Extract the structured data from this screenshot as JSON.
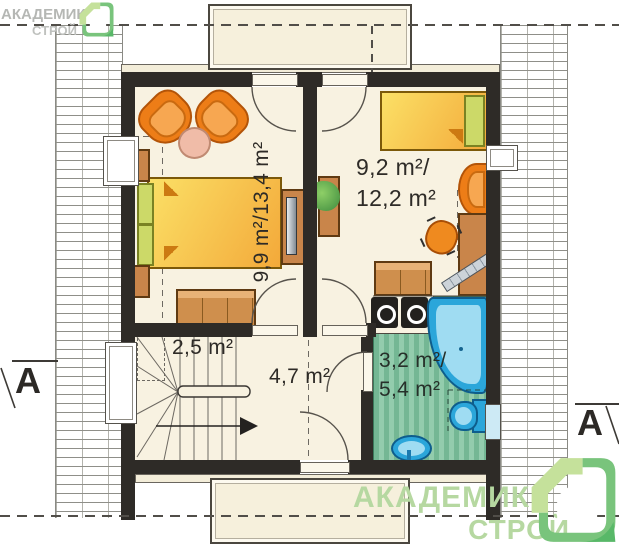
{
  "branding": {
    "logo_top_left": {
      "line1": "АКАДЕМИК",
      "line2": "СТРОЙ"
    },
    "logo_bottom_right": {
      "line1": "АКАДЕМИК",
      "line2": "СТРОЙ"
    }
  },
  "section_markers": {
    "left_label": "A",
    "right_label": "A"
  },
  "rooms": {
    "bedroom_left": {
      "area_label": "9,9 m²/13,4 m²"
    },
    "bedroom_right": {
      "area_line1": "9,2 m²/",
      "area_line2": "12,2 m²"
    },
    "staircase": {
      "area_label": "2,5 m²"
    },
    "hallway": {
      "area_label": "4,7 m²"
    },
    "bathroom": {
      "area_line1": "3,2 m²/",
      "area_line2": "5,4 m²"
    }
  },
  "palette": {
    "logo_green": "#8dc63f",
    "logo_gray_text": "#b5b7b4",
    "logo_light_green_text": "#b6d8a1",
    "wall_color": "#2e2b27",
    "floor_cream": "#f8f2e1",
    "furniture_orange": "#ed7d17",
    "furniture_brown": "#cf8f4d",
    "bed_yellow": "#f9d14f",
    "bath_blue": "#2ba6da",
    "bath_floor_green": "#74b794",
    "headboard_green": "#ccd968"
  }
}
